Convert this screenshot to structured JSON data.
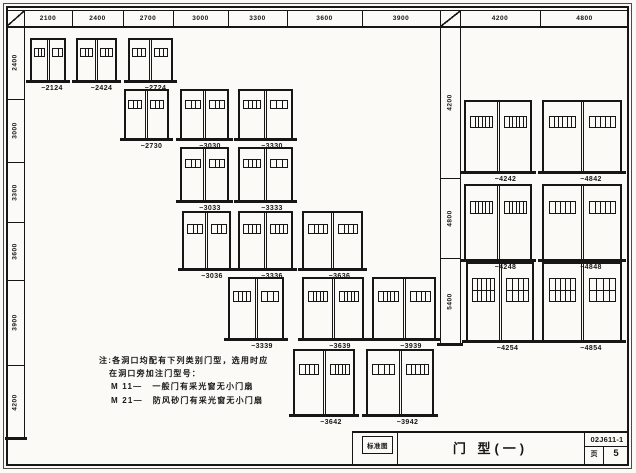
{
  "colors": {
    "ink": "#161616",
    "paper": "#fbfaf6"
  },
  "sheet": {
    "stamp_label": "标准图",
    "title": "门 型(一)",
    "doc_number": "02J611-1",
    "page_label": "页",
    "page_number": "5"
  },
  "left_table": {
    "col_headers": [
      "2100",
      "2400",
      "2700",
      "3000",
      "3300",
      "3600",
      "3900"
    ],
    "row_headers": [
      "2400",
      "3000",
      "3300",
      "3600",
      "3900",
      "4200"
    ]
  },
  "right_table": {
    "col_headers": [
      "4200",
      "4800"
    ],
    "row_headers": [
      "4200",
      "4800",
      "5400"
    ]
  },
  "doors": [
    {
      "label": "−2124"
    },
    {
      "label": "−2424"
    },
    {
      "label": "−2724"
    },
    {
      "label": "−2730"
    },
    {
      "label": "−3030"
    },
    {
      "label": "−3330"
    },
    {
      "label": "−3033"
    },
    {
      "label": "−3333"
    },
    {
      "label": "−3036"
    },
    {
      "label": "−3336"
    },
    {
      "label": "−3636"
    },
    {
      "label": "−3339"
    },
    {
      "label": "−3639"
    },
    {
      "label": "−3939"
    },
    {
      "label": "−3642"
    },
    {
      "label": "−3942"
    },
    {
      "label": "−4242"
    },
    {
      "label": "−4842"
    },
    {
      "label": "−4248"
    },
    {
      "label": "−4848"
    },
    {
      "label": "−4254"
    },
    {
      "label": "−4854"
    }
  ],
  "notes": {
    "line1": "注:各洞口均配有下列类别门型，选用时应",
    "line2": "在洞口旁加注门型号：",
    "items": [
      {
        "code": "M 11—",
        "desc": "一般门有采光窗无小门扇"
      },
      {
        "code": "M 21—",
        "desc": "防风砂门有采光窗无小门扇"
      }
    ]
  }
}
